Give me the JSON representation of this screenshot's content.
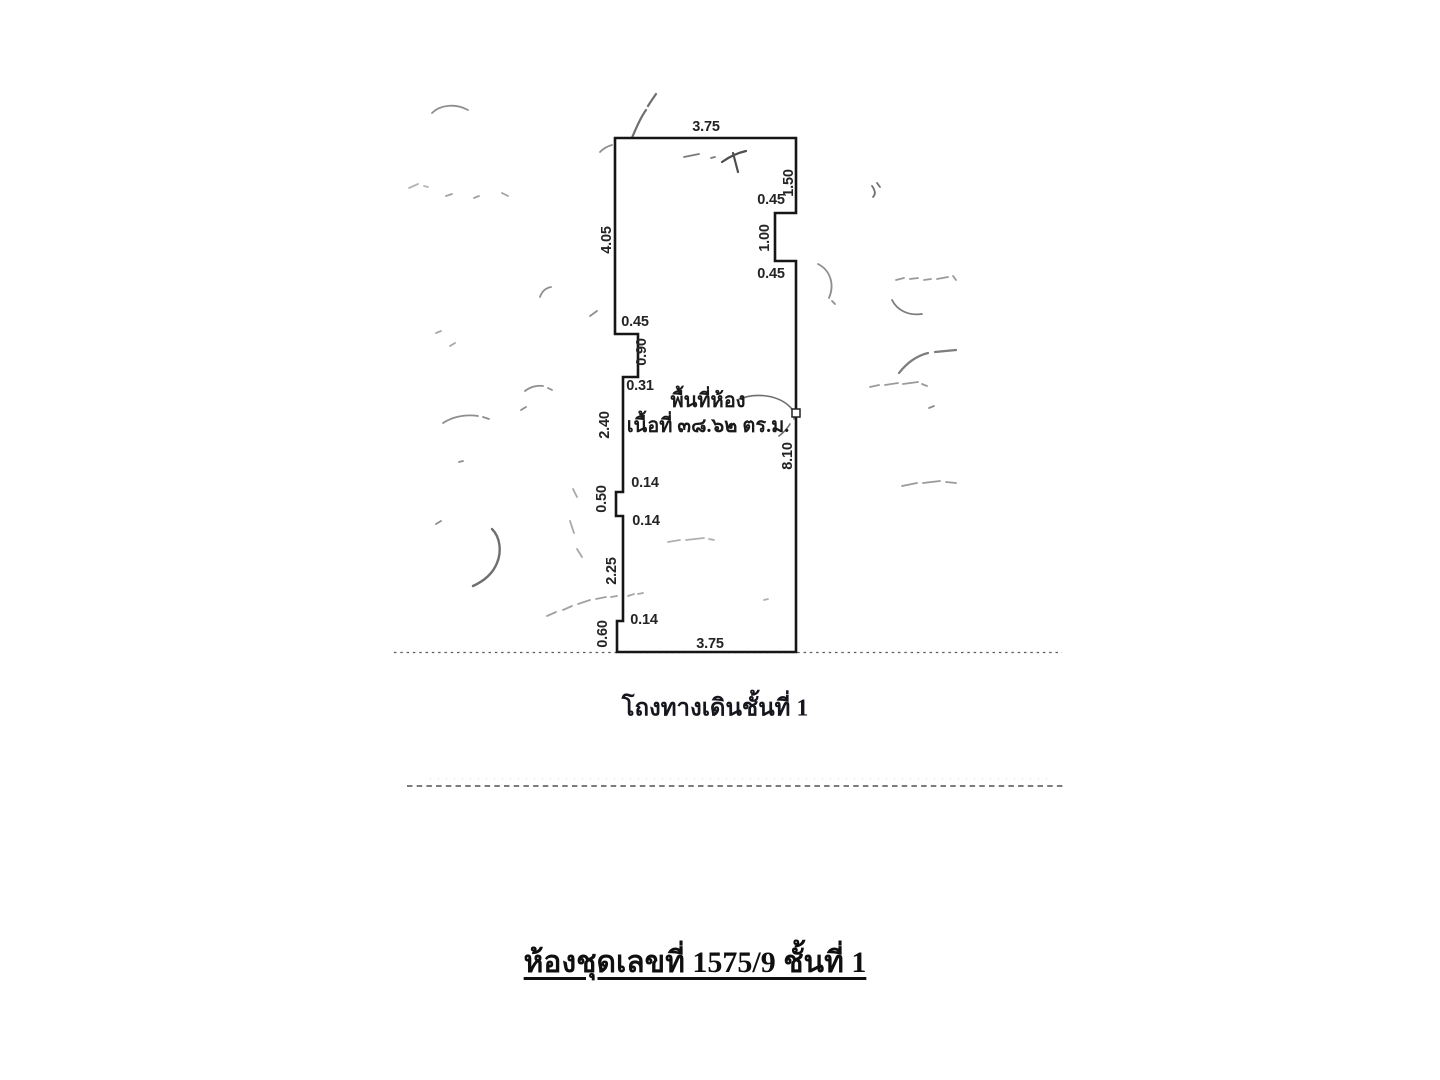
{
  "page": {
    "background": "#ffffff",
    "ink_color": "#161616",
    "artifact_color": "#8c8c8c"
  },
  "floor_plan": {
    "room_label": {
      "line1": "พื้นที่ห้อง",
      "line2": "เนื้อที่ ๓๘.๖๒ ตร.ม."
    },
    "dimensions": [
      {
        "edge": "top-width",
        "value": "3.75"
      },
      {
        "edge": "right-upper",
        "value": "1.50"
      },
      {
        "edge": "right-notch-top",
        "value": "0.45"
      },
      {
        "edge": "right-notch-depth",
        "value": "1.00"
      },
      {
        "edge": "right-notch-bottom",
        "value": "0.45"
      },
      {
        "edge": "right-lower",
        "value": "8.10"
      },
      {
        "edge": "left-upper",
        "value": "4.05"
      },
      {
        "edge": "left-step-top",
        "value": "0.45"
      },
      {
        "edge": "left-step-height",
        "value": "0.90"
      },
      {
        "edge": "left-step-return",
        "value": "0.31"
      },
      {
        "edge": "left-middle",
        "value": "2.40"
      },
      {
        "edge": "left-bump-top",
        "value": "0.14"
      },
      {
        "edge": "left-bump-height",
        "value": "0.50"
      },
      {
        "edge": "left-bump-bottom",
        "value": "0.14"
      },
      {
        "edge": "left-lower",
        "value": "2.25"
      },
      {
        "edge": "left-bottom-step",
        "value": "0.14"
      },
      {
        "edge": "left-bottom",
        "value": "0.60"
      },
      {
        "edge": "bottom-width",
        "value": "3.75"
      }
    ]
  },
  "labels": {
    "corridor": "โถงทางเดินชั้นที่ 1",
    "title": "ห้องชุดเลขที่ 1575/9 ชั้นที่ 1"
  }
}
